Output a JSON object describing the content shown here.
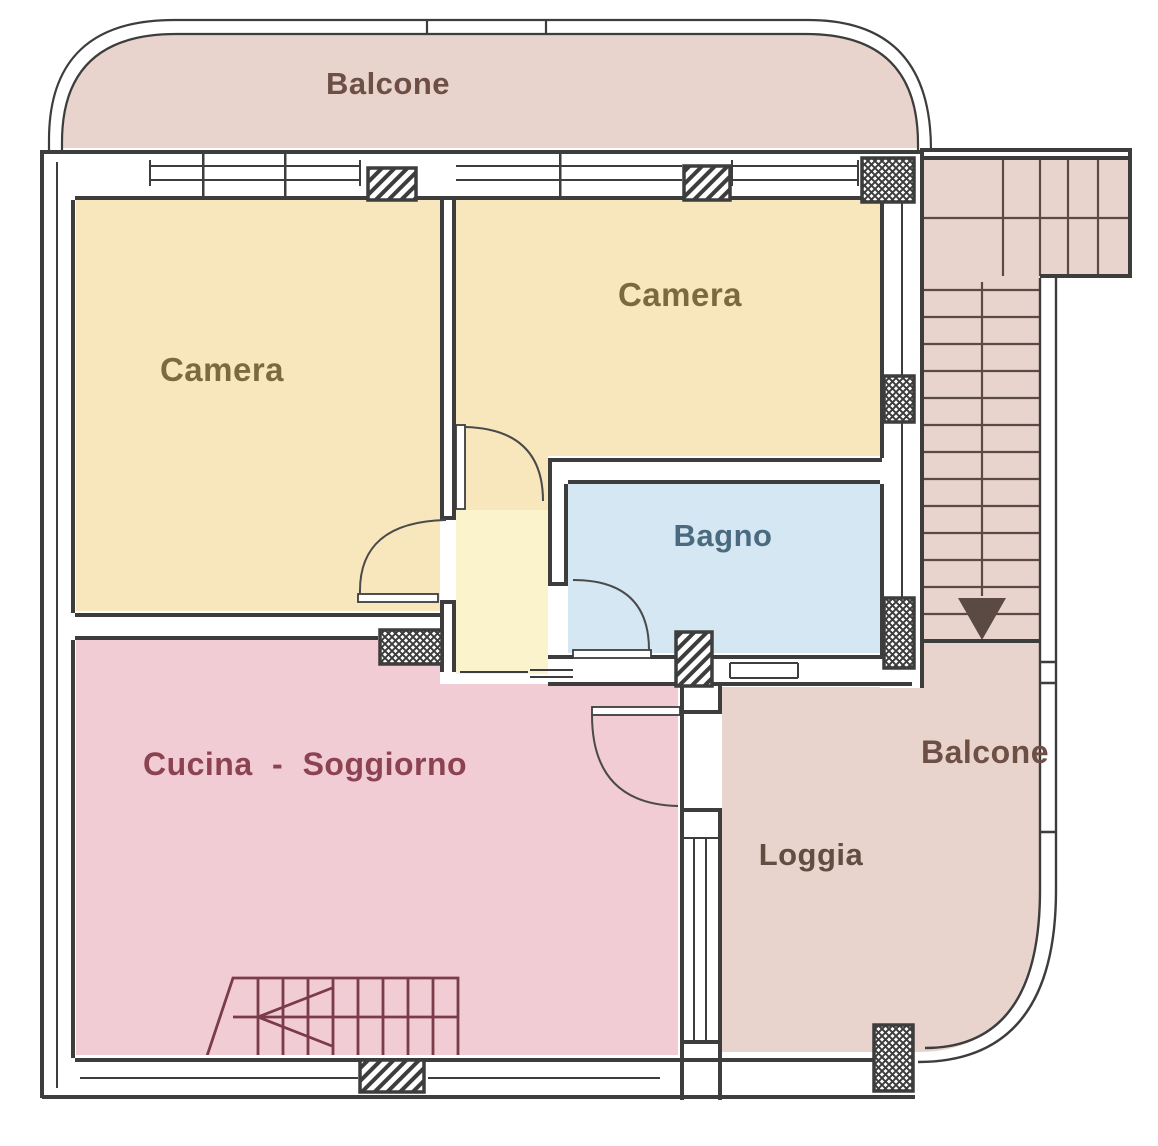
{
  "rooms": {
    "balcone_top": {
      "label": "Balcone"
    },
    "camera_left": {
      "label": "Camera"
    },
    "camera_right": {
      "label": "Camera"
    },
    "bagno": {
      "label": "Bagno"
    },
    "cucina_soggiorno": {
      "label": "Cucina - Soggiorno"
    },
    "loggia": {
      "label": "Loggia"
    },
    "balcone_right": {
      "label": "Balcone"
    }
  },
  "colors": {
    "camera": "#f8e7bd",
    "hall": "#fbf3cb",
    "bagno": "#d5e7f2",
    "cucina": "#f2ccd4",
    "outdoor": "#e8d4cd",
    "wall_line": "#3d3d3d",
    "stair_line_outdoor": "#5b4a44",
    "stair_line_indoor": "#7b3c49",
    "label_balcone": "#6d4f45",
    "label_camera": "#7c6a3e",
    "label_bagno": "#4a6a80",
    "label_cucina": "#8c4351",
    "label_loggia": "#634c42"
  }
}
